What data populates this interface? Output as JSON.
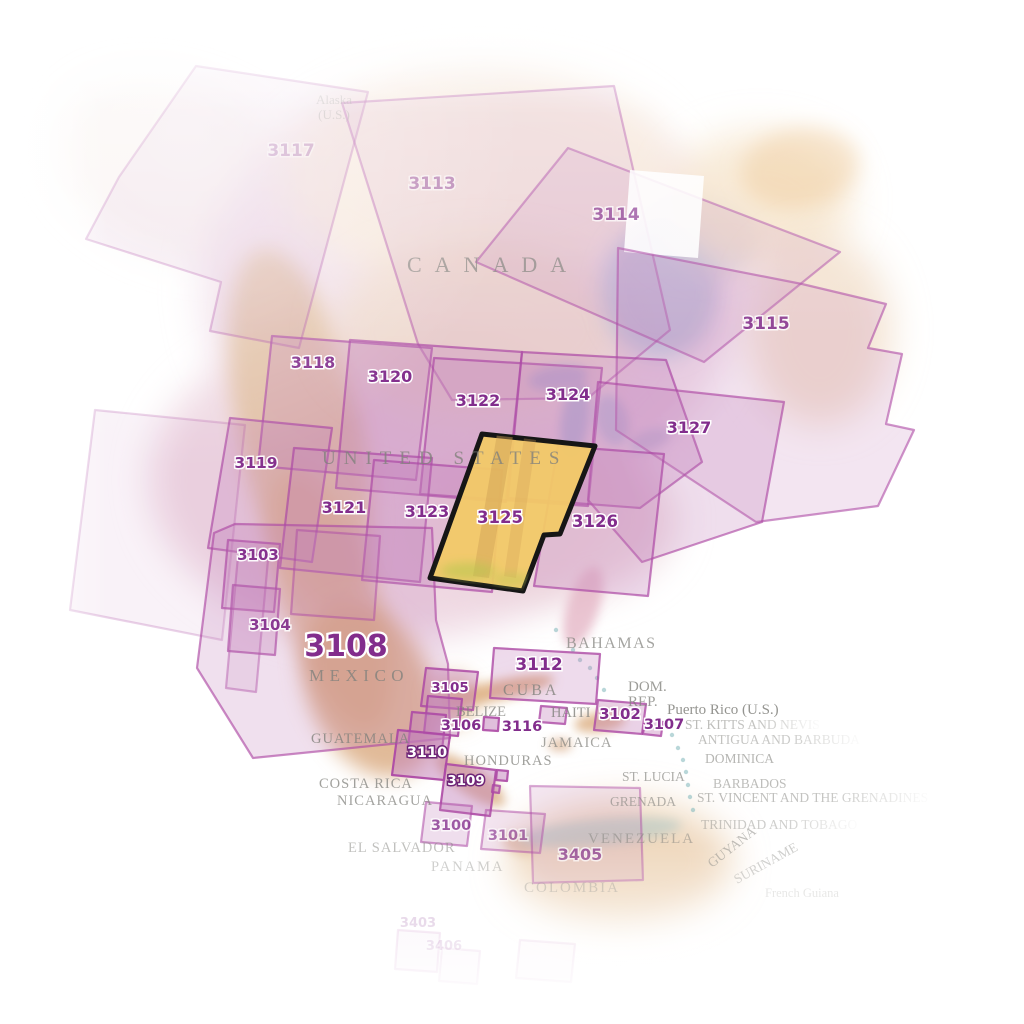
{
  "map_title": "North America chart index map",
  "palette": {
    "region_fill": "#c27eba",
    "region_stroke": "#ad4aa5",
    "number_color": "#822d8c",
    "number_halo": "#ffffff",
    "white_number_color": "#ffffff",
    "white_number_halo": "#6f2577",
    "highlight_fill": "#f2c967",
    "highlight_stroke": "#161616",
    "country_color": "#82827d",
    "land_pink": "#eed7e2",
    "mountain_tan": "#ddb48c",
    "water_blue": "#b9c4db"
  },
  "highlight": {
    "id": "3125",
    "label": "3125",
    "points": "482,434 595,446 560,534 544,535 523,591 430,578",
    "label_x": 500,
    "label_y": 523,
    "fs": 16.5
  },
  "regions": [
    {
      "id": "3117",
      "label": "3117",
      "points": "196,66 368,92 299,348 210,331 221,282 86,239 119,177",
      "fo": 0.14,
      "so": 0.4,
      "lx": 291,
      "ly": 156,
      "fs": 17,
      "lop": 0.42,
      "lstyle": "purple"
    },
    {
      "id": "3113",
      "label": "3113",
      "points": "342,103 614,86 670,330 588,398 452,400 418,344",
      "fo": 0.15,
      "so": 0.5,
      "lx": 432,
      "ly": 189,
      "fs": 17,
      "lop": 0.55,
      "lstyle": "purple"
    },
    {
      "id": "3114",
      "label": "3114",
      "points": "568,148 840,252 704,362 476,262",
      "fo": 0.18,
      "so": 0.55,
      "lx": 616,
      "ly": 220,
      "fs": 17,
      "lop": 0.75,
      "lstyle": "purple"
    },
    {
      "id": "white-notch",
      "label": "",
      "points": "630,170 704,176 698,258 624,252",
      "white": true,
      "fo": 0.88,
      "so": 0
    },
    {
      "id": "3115",
      "label": "3115",
      "points": "618,248 802,284 886,304 868,348 902,354 886,424 914,430 878,506 756,522 616,430",
      "fo": 0.2,
      "so": 0.6,
      "lx": 766,
      "ly": 329,
      "fs": 17,
      "lop": 0.85,
      "lstyle": "purple"
    },
    {
      "id": "3118",
      "label": "3118",
      "points": "272,336 432,348 416,480 258,466",
      "fo": 0.28,
      "so": 0.7,
      "lx": 313,
      "ly": 368,
      "fs": 16,
      "lop": 1,
      "lstyle": "purple"
    },
    {
      "id": "3120",
      "label": "3120",
      "points": "350,340 522,352 506,502 336,488",
      "fo": 0.28,
      "so": 0.7,
      "lx": 390,
      "ly": 382,
      "fs": 16,
      "lop": 1,
      "lstyle": "purple"
    },
    {
      "id": "3122",
      "label": "3122",
      "points": "434,358 602,368 588,506 420,494",
      "fo": 0.28,
      "so": 0.7,
      "lx": 478,
      "ly": 406,
      "fs": 16,
      "lop": 1,
      "lstyle": "purple"
    },
    {
      "id": "3124",
      "label": "3124",
      "points": "522,352 666,360 702,462 640,508 508,498",
      "fo": 0.28,
      "so": 0.7,
      "lx": 568,
      "ly": 400,
      "fs": 16,
      "lop": 1,
      "lstyle": "purple"
    },
    {
      "id": "3127",
      "label": "3127",
      "points": "598,382 784,402 762,522 642,562 588,500",
      "fo": 0.26,
      "so": 0.65,
      "lx": 689,
      "ly": 433,
      "fs": 16,
      "lop": 1,
      "lstyle": "purple"
    },
    {
      "id": "3119",
      "label": "3119",
      "points": "230,418 332,428 312,562 208,548",
      "fo": 0.28,
      "so": 0.7,
      "lx": 256,
      "ly": 468,
      "fs": 15.5,
      "lop": 0.95,
      "lstyle": "purple"
    },
    {
      "id": "3121",
      "label": "3121",
      "points": "294,448 432,458 420,582 280,568",
      "fo": 0.28,
      "so": 0.7,
      "lx": 344,
      "ly": 513,
      "fs": 16,
      "lop": 1,
      "lstyle": "purple"
    },
    {
      "id": "3123",
      "label": "3123",
      "points": "374,460 502,470 492,592 362,580",
      "fo": 0.28,
      "so": 0.7,
      "lx": 427,
      "ly": 517,
      "fs": 16,
      "lop": 1,
      "lstyle": "purple"
    },
    {
      "id": "3126",
      "label": "3126",
      "points": "558,446 664,454 648,596 534,586",
      "fo": 0.28,
      "so": 0.7,
      "lx": 595,
      "ly": 527,
      "fs": 16.5,
      "lop": 1,
      "lstyle": "purple"
    },
    {
      "id": "box-west",
      "label": "",
      "points": "95,410 245,425 222,640 70,610",
      "fo": 0.1,
      "so": 0.25
    },
    {
      "id": "3103",
      "label": "3103",
      "points": "228,540 280,544 274,612 222,608",
      "fo": 0.32,
      "so": 0.75,
      "lx": 258,
      "ly": 560,
      "fs": 15,
      "lop": 0.95,
      "lstyle": "purple"
    },
    {
      "id": "box-baja",
      "label": "",
      "points": "238,556 268,560 256,692 226,688",
      "fo": 0.16,
      "so": 0.45
    },
    {
      "id": "3104",
      "label": "3104",
      "points": "233,585 280,589 275,655 228,651",
      "fo": 0.3,
      "so": 0.7,
      "lx": 270,
      "ly": 630,
      "fs": 15,
      "lop": 0.9,
      "lstyle": "purple"
    },
    {
      "id": "3108",
      "label": "3108",
      "points": "235,524 432,528 436,620 448,664 450,738 253,758 197,668 214,533",
      "fo": 0.24,
      "so": 0.65,
      "lx": 346,
      "ly": 656,
      "fs": 30,
      "lop": 1,
      "lstyle": "purple"
    },
    {
      "id": "box-mex",
      "label": "",
      "points": "297,530 380,536 374,620 291,614",
      "fo": 0.18,
      "so": 0.5
    },
    {
      "id": "3105",
      "label": "3105",
      "points": "426,668 478,672 473,710 421,706",
      "fo": 0.4,
      "so": 0.85,
      "lx": 450,
      "ly": 692,
      "fs": 13.5,
      "lop": 1,
      "lstyle": "purple"
    },
    {
      "id": "3112",
      "label": "3112",
      "points": "494,648 600,654 596,704 490,698",
      "fo": 0.28,
      "so": 0.8,
      "lx": 539,
      "ly": 670,
      "fs": 17,
      "lop": 1,
      "lstyle": "purple"
    },
    {
      "id": "box-guatemala-1",
      "label": "",
      "points": "428,696 462,699 458,736 424,733",
      "fo": 0.45,
      "so": 0.9
    },
    {
      "id": "box-guatemala-2",
      "label": "",
      "points": "412,712 446,715 442,750 408,747",
      "fo": 0.45,
      "so": 0.9
    },
    {
      "id": "3110",
      "label": "3110",
      "points": "398,730 450,735 444,780 392,775",
      "fo": 0.5,
      "so": 0.95,
      "lx": 427,
      "ly": 757,
      "fs": 14.5,
      "lop": 1,
      "lstyle": "white"
    },
    {
      "id": "3109",
      "label": "3109",
      "points": "446,764 496,770 490,816 440,810",
      "fo": 0.45,
      "so": 0.9,
      "lx": 466,
      "ly": 785,
      "fs": 13.5,
      "lop": 1,
      "lstyle": "white"
    },
    {
      "id": "box-small-1",
      "label": "",
      "points": "497,770 508,771 507,781 496,780",
      "fo": 0.5,
      "so": 0.9
    },
    {
      "id": "box-small-2",
      "label": "",
      "points": "493,785 500,786 499,793 492,792",
      "fo": 0.45,
      "so": 0.85
    },
    {
      "id": "3106",
      "label": "3106",
      "points": "484,717 499,718 498,731 483,730",
      "fo": 0.5,
      "so": 0.9,
      "lx": 461,
      "ly": 730,
      "fs": 14.5,
      "lop": 1,
      "lstyle": "purple"
    },
    {
      "id": "3116",
      "label": "3116",
      "points": "541,706 567,708 565,724 539,722",
      "fo": 0.35,
      "so": 0.8,
      "lx": 522,
      "ly": 731,
      "fs": 14.5,
      "lop": 1,
      "lstyle": "purple"
    },
    {
      "id": "3102",
      "label": "3102",
      "points": "598,700 646,704 642,734 594,730",
      "fo": 0.35,
      "so": 0.8,
      "lx": 620,
      "ly": 719,
      "fs": 15,
      "lop": 1,
      "lstyle": "purple"
    },
    {
      "id": "3107",
      "label": "3107",
      "points": "645,720 663,722 661,736 643,734",
      "fo": 0.4,
      "so": 0.8,
      "lx": 664,
      "ly": 729,
      "fs": 14.5,
      "lop": 1,
      "lstyle": "purple"
    },
    {
      "id": "3100",
      "label": "3100",
      "points": "426,802 472,806 467,846 421,842",
      "fo": 0.26,
      "so": 0.55,
      "lx": 451,
      "ly": 830,
      "fs": 14.5,
      "lop": 0.75,
      "lstyle": "purple"
    },
    {
      "id": "3101",
      "label": "3101",
      "points": "486,810 545,814 540,853 481,849",
      "fo": 0.2,
      "so": 0.5,
      "lx": 508,
      "ly": 840,
      "fs": 14.5,
      "lop": 0.6,
      "lstyle": "purple"
    },
    {
      "id": "3405",
      "label": "3405",
      "points": "530,786 640,788 643,880 533,883",
      "fo": 0.18,
      "so": 0.45,
      "lx": 580,
      "ly": 860,
      "fs": 16,
      "lop": 0.7,
      "lstyle": "purple"
    },
    {
      "id": "3403",
      "label": "3403",
      "points": "398,930 440,933 437,972 395,969",
      "fo": 0.08,
      "so": 0.2,
      "lx": 418,
      "ly": 927,
      "fs": 13,
      "lop": 0.3,
      "lstyle": "purple"
    },
    {
      "id": "3406",
      "label": "3406",
      "points": "442,948 480,951 477,984 439,981",
      "fo": 0.06,
      "so": 0.16,
      "lx": 444,
      "ly": 950,
      "fs": 13,
      "lop": 0.25,
      "lstyle": "purple"
    },
    {
      "id": "box-faint-south",
      "label": "",
      "points": "520,940 575,944 571,982 516,978",
      "fo": 0.05,
      "so": 0.14
    }
  ],
  "countries": [
    {
      "id": "alaska-line1",
      "text": "Alaska",
      "x": 334,
      "y": 104,
      "fs": 13,
      "op": 0.4,
      "anchor": "middle"
    },
    {
      "id": "alaska-line2",
      "text": "(U.S.)",
      "x": 334,
      "y": 119,
      "fs": 13,
      "op": 0.4,
      "anchor": "middle"
    },
    {
      "id": "canada",
      "text": "CANADA",
      "x": 407,
      "y": 272,
      "fs": 22,
      "ls": 13,
      "op": 0.72
    },
    {
      "id": "united-states",
      "text": "UNITED STATES",
      "x": 322,
      "y": 464,
      "fs": 19,
      "ls": 8,
      "op": 0.8
    },
    {
      "id": "mexico",
      "text": "MEXICO",
      "x": 309,
      "y": 681,
      "fs": 17,
      "ls": 5.5,
      "op": 0.8
    },
    {
      "id": "bahamas",
      "text": "BAHAMAS",
      "x": 566,
      "y": 648,
      "fs": 16,
      "ls": 1.5,
      "op": 0.72
    },
    {
      "id": "cuba",
      "text": "CUBA",
      "x": 503,
      "y": 695,
      "fs": 16,
      "ls": 3,
      "op": 0.8
    },
    {
      "id": "dom",
      "text": "DOM.",
      "x": 628,
      "y": 691,
      "fs": 15,
      "op": 0.78
    },
    {
      "id": "rep",
      "text": "REP.",
      "x": 628,
      "y": 706,
      "fs": 15,
      "op": 0.78
    },
    {
      "id": "puerto-rico",
      "text": "Puerto Rico (U.S.)",
      "x": 667,
      "y": 714,
      "fs": 15,
      "op": 0.85
    },
    {
      "id": "st-kitts-and-nevis",
      "text": "ST. KITTS AND NEVIS",
      "x": 685,
      "y": 729,
      "fs": 13.5,
      "op": 0.55,
      "fade": 1
    },
    {
      "id": "antigua-and-barbuda",
      "text": "ANTIGUA AND BARBUDA",
      "x": 698,
      "y": 744,
      "fs": 13.5,
      "op": 0.5,
      "fade": 1
    },
    {
      "id": "dominica",
      "text": "DOMINICA",
      "x": 705,
      "y": 763,
      "fs": 13.5,
      "op": 0.58
    },
    {
      "id": "st-lucia",
      "text": "ST. LUCIA",
      "x": 622,
      "y": 781,
      "fs": 13.5,
      "op": 0.65
    },
    {
      "id": "barbados",
      "text": "BARBADOS",
      "x": 713,
      "y": 788,
      "fs": 13.5,
      "op": 0.52
    },
    {
      "id": "st-vincent",
      "text": "ST. VINCENT AND THE GRENADINES",
      "x": 697,
      "y": 802,
      "fs": 13.5,
      "op": 0.55,
      "fade": 1
    },
    {
      "id": "grenada",
      "text": "GRENADA",
      "x": 610,
      "y": 806,
      "fs": 13.5,
      "op": 0.6
    },
    {
      "id": "trinidad-and-tobago",
      "text": "TRINIDAD AND TOBAGO",
      "x": 701,
      "y": 829,
      "fs": 13.5,
      "op": 0.45,
      "fade": 1
    },
    {
      "id": "venezuela",
      "text": "VENEZUELA",
      "x": 588,
      "y": 843,
      "fs": 15,
      "ls": 2,
      "op": 0.5
    },
    {
      "id": "guyana",
      "text": "GUYANA",
      "x": 712,
      "y": 868,
      "fs": 13.5,
      "op": 0.5,
      "rot": -38
    },
    {
      "id": "suriname",
      "text": "SURINAME",
      "x": 737,
      "y": 884,
      "fs": 13.5,
      "op": 0.4,
      "rot": -29
    },
    {
      "id": "french-guiana",
      "text": "French Guiana",
      "x": 765,
      "y": 897,
      "fs": 12.5,
      "op": 0.25
    },
    {
      "id": "colombia",
      "text": "COLOMBIA",
      "x": 524,
      "y": 892,
      "fs": 15,
      "ls": 2,
      "op": 0.4
    },
    {
      "id": "belize",
      "text": "BELIZE",
      "x": 456,
      "y": 716,
      "fs": 14.5,
      "op": 0.75
    },
    {
      "id": "haiti",
      "text": "HAITI",
      "x": 551,
      "y": 717,
      "fs": 14.5,
      "op": 0.8
    },
    {
      "id": "jamaica",
      "text": "JAMAICA",
      "x": 541,
      "y": 747,
      "fs": 14.5,
      "ls": 1,
      "op": 0.7
    },
    {
      "id": "guatemala",
      "text": "GUATEMALA",
      "x": 311,
      "y": 743,
      "fs": 14.5,
      "ls": 1,
      "op": 0.8
    },
    {
      "id": "honduras",
      "text": "HONDURAS",
      "x": 464,
      "y": 765,
      "fs": 14.5,
      "ls": 1,
      "op": 0.75
    },
    {
      "id": "costa-rica",
      "text": "COSTA RICA",
      "x": 319,
      "y": 788,
      "fs": 14.5,
      "ls": 1,
      "op": 0.75
    },
    {
      "id": "nicaragua",
      "text": "NICARAGUA",
      "x": 337,
      "y": 805,
      "fs": 14.5,
      "ls": 1,
      "op": 0.72
    },
    {
      "id": "el-salvador",
      "text": "EL SALVADOR",
      "x": 348,
      "y": 852,
      "fs": 14.5,
      "ls": 1,
      "op": 0.5
    },
    {
      "id": "panama",
      "text": "PANAMA",
      "x": 431,
      "y": 871,
      "fs": 14.5,
      "ls": 2,
      "op": 0.42
    }
  ]
}
